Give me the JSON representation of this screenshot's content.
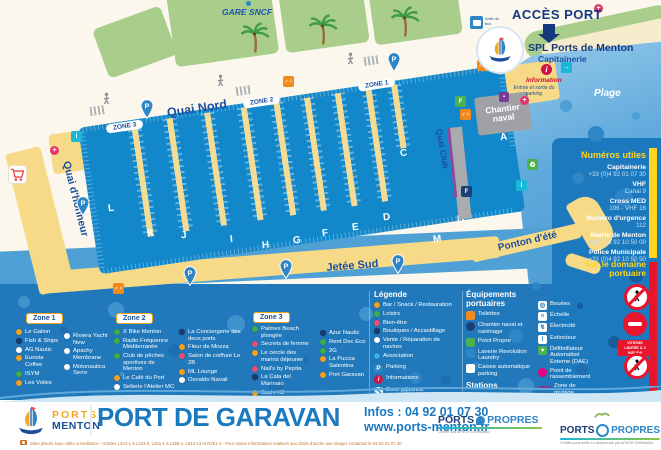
{
  "top": {
    "gare": "GARE SNCF",
    "bus_stop": "Arrêt de bus",
    "acces_port": "ACCÈS PORT",
    "spl": "SPL Ports de Menton",
    "capitainerie": "Capitainerie",
    "information": "Information",
    "entree_parking": "Entrée et sortie du parking",
    "plage": "Plage"
  },
  "map": {
    "quai_nord": "Quai Nord",
    "quai_honneur": "Quai d'honneur",
    "jetee_sud": "Jetée Sud",
    "ponton_ete": "Ponton d'été",
    "quai_club": "Quai Club",
    "chantier_naval_1": "Chantier",
    "chantier_naval_2": "naval",
    "zone_pills": [
      "ZONE 1",
      "ZONE 2",
      "ZONE 3"
    ],
    "piers": [
      "L",
      "K",
      "J",
      "I",
      "H",
      "G",
      "F",
      "E",
      "D",
      "C",
      "M",
      "B",
      "A"
    ]
  },
  "sidebar": {
    "title": "Numéros utiles",
    "entries": [
      {
        "label": "Capitainerie",
        "value": "+33 (0)4 92 01 07 30"
      },
      {
        "label": "VHF",
        "value": "Canal 9"
      },
      {
        "label": "Cross MED",
        "value": "196 - VHF 16"
      },
      {
        "label": "Numéro d'urgence",
        "value": "112"
      },
      {
        "label": "Mairie de Menton",
        "value": "+33 (0)4 92 10 50 00"
      },
      {
        "label": "Police Municipale",
        "value": "+33 (0)4 92 10 50 50"
      }
    ],
    "domaine_title": "Sur le domaine portuaire",
    "speed_sign": "VITESSE LIMITÉE À 3 NŒUDS"
  },
  "legend": {
    "title": "Légende",
    "categories": [
      {
        "label": "Bar / Snack / Restauration",
        "color": "#F6A01D"
      },
      {
        "label": "Loisirs",
        "color": "#3FAE49"
      },
      {
        "label": "Bien-être",
        "color": "#E94F75"
      },
      {
        "label": "Boutiques / Accastillage",
        "color": "#1B3A6B"
      },
      {
        "label": "Vente / Réparation de navires",
        "color": "#FFFFFF"
      },
      {
        "label": "Association",
        "color": "#35AEE3"
      }
    ],
    "extras": [
      {
        "label": "Parking",
        "type": "parking"
      },
      {
        "label": "Informations",
        "type": "info"
      },
      {
        "label": "Zone piétonne",
        "type": "pieton"
      }
    ]
  },
  "equipements": {
    "title": "Équipements portuaires",
    "left": [
      {
        "label": "Toilettes",
        "type": "toilets"
      },
      {
        "label": "Chantier naval et carénage",
        "type": "yard"
      },
      {
        "label": "Point Propre",
        "type": "propre"
      },
      {
        "label": "Laverie Revolution Laundry",
        "type": "laundry"
      },
      {
        "label": "Caisse automatique parking",
        "type": "cash"
      }
    ],
    "stations_title": "Stations",
    "stations": [
      {
        "name": "YSBlue",
        "sub": "(carburant)",
        "type": "ys"
      },
      {
        "name": "Atol Liberté",
        "sub": "Borne de recharge",
        "type": "atol"
      }
    ],
    "right": [
      {
        "label": "Bouées",
        "type": "buoy"
      },
      {
        "label": "Échelle",
        "type": "ladder"
      },
      {
        "label": "Électricité",
        "type": "power"
      },
      {
        "label": "Extincteur",
        "type": "ext"
      },
      {
        "label": "Défibrillateur Automatisé Externe (DAE)",
        "type": "dae"
      },
      {
        "label": "Point de rassemblement",
        "type": "point"
      },
      {
        "label": "Zone de grutage",
        "type": "grut"
      },
      {
        "label": "Quai d'Accueil",
        "type": "quai"
      }
    ]
  },
  "zones": {
    "zone1_title": "Zone 1",
    "zone2_title": "Zone 2",
    "zone3_title": "Zone 3",
    "zone1a": [
      {
        "label": "Le Galion",
        "color": "#F6A01D"
      },
      {
        "label": "Fish & Ships",
        "color": "#1B3A6B"
      },
      {
        "label": "AG Nautic",
        "color": "#FFFFFF"
      },
      {
        "label": "Eunoia Coffee",
        "color": "#F6A01D"
      },
      {
        "label": "ISYM",
        "color": "#3FAE49"
      },
      {
        "label": "Les Voiles",
        "color": "#F6A01D"
      }
    ],
    "zone1b": [
      {
        "label": "Riviera Yacht New",
        "color": "#FFFFFF"
      },
      {
        "label": "Apachy Membrane",
        "color": "#FFFFFF"
      },
      {
        "label": "Motonautica Serre",
        "color": "#FFFFFF"
      }
    ],
    "zone2a": [
      {
        "label": "X Bike Menton",
        "color": "#3FAE49"
      },
      {
        "label": "Radio Fréquence Méditerranée",
        "color": "#3FAE49"
      },
      {
        "label": "Club de pêches sportives de Menton",
        "color": "#3FAE49"
      },
      {
        "label": "Le Café du Port",
        "color": "#F6A01D"
      },
      {
        "label": "Sellerie l'Atelier MC",
        "color": "#FFFFFF"
      }
    ],
    "zone2b": [
      {
        "label": "La Conciergerie des deux ports",
        "color": "#1B3A6B"
      },
      {
        "label": "Fleur de Mozza",
        "color": "#F6A01D"
      },
      {
        "label": "Salon de coiffure Le 2B",
        "color": "#E94F75"
      },
      {
        "label": "ML Lounge",
        "color": "#F6A01D"
      },
      {
        "label": "Osvaldo Navali",
        "color": "#FFFFFF"
      }
    ],
    "zone3a": [
      {
        "label": "Palmes Beach plongée",
        "color": "#3FAE49"
      },
      {
        "label": "Secrets de femme",
        "color": "#E94F75"
      },
      {
        "label": "Le cercle des marins déjeuner",
        "color": "#F6A01D"
      },
      {
        "label": "Nail's by Pepita",
        "color": "#E94F75"
      },
      {
        "label": "La Cala del Marinaio",
        "color": "#1B3A6B"
      },
      {
        "label": "Sushi K9",
        "color": "#F6A01D"
      }
    ],
    "zone3b": [
      {
        "label": "Azur Nautic",
        "color": "#1B3A6B"
      },
      {
        "label": "Rent Dec Eco",
        "color": "#3FAE49"
      },
      {
        "label": "2G",
        "color": "#3FAE49"
      },
      {
        "label": "La Puccia Salentina",
        "color": "#F6A01D"
      },
      {
        "label": "Port Garavan",
        "color": "#F6A01D"
      }
    ]
  },
  "footer": {
    "brand_top": "PORTS",
    "brand_bottom": "MENTON",
    "title": "PORT DE GARAVAN",
    "infos": "Infos : 04 92 01 07 30",
    "website": "www.ports-menton.fr",
    "fine_print": "Sites placés sous vidéo surveillance - Articles L223-1 à L223-9, L251-1 à L255-1, L613-13 et R251-4 - Pour toutes informations relatives aux droits d'accès aux images contactez le 04 92 01 07 30",
    "pp1_a": "PORTS",
    "pp1_b": "PROPRES",
    "pp1_sub": "Certifié par AFNOR Certification",
    "pp2_a": "PORTS",
    "pp2_b": "PROPRES",
    "pp2_sub": "Certifié ports actifs en biodiversité par AFNOR Certification"
  },
  "icons": {
    "parking_pin": "P",
    "information": "i",
    "toilets": "♂♀",
    "recycle": "♻",
    "first_aid": "+",
    "entrance": "→",
    "fuel": "F",
    "electricity": "↯",
    "buoy": "◎",
    "ladder": "≡",
    "extinguisher": "!",
    "dae_heart": "♥"
  },
  "colors": {
    "accent_yellow": "#FFD51E",
    "accent_red": "#E8152C",
    "navy": "#1C4F9E",
    "harbor": "#1287C9",
    "panel_blue": "#1D79BE",
    "quay_yellow": "#F7DA88"
  }
}
